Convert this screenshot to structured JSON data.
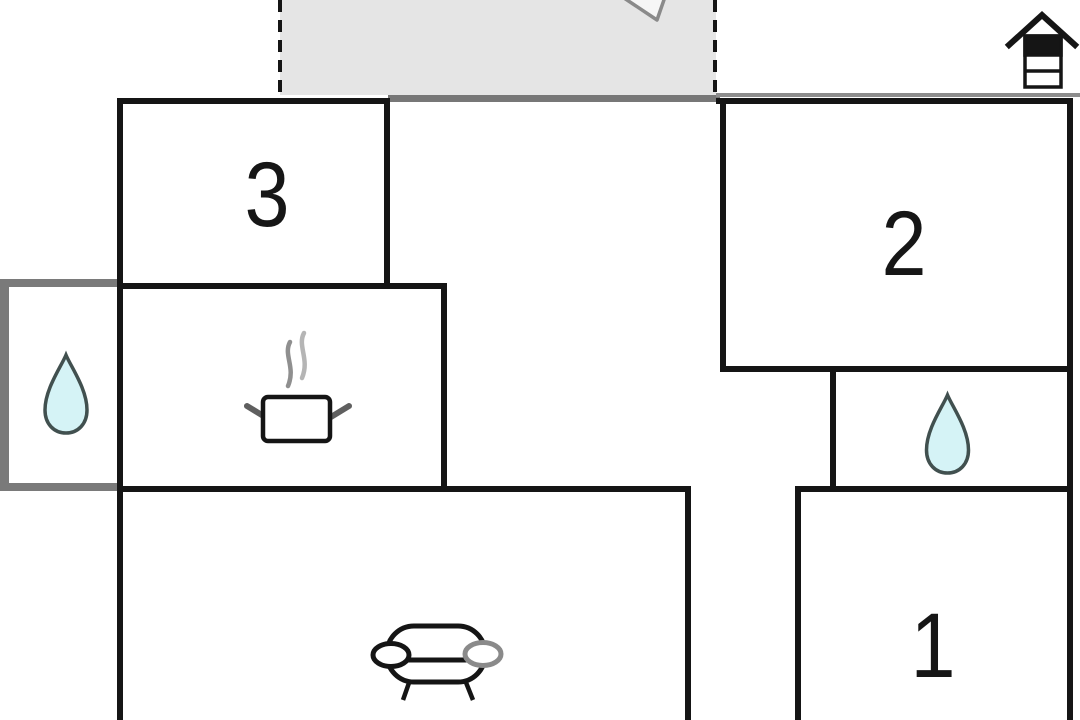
{
  "floorplan": {
    "kind": "holiday-home floor plan",
    "areas": {
      "terrace": {
        "icons": [
          "parasol-top-icon"
        ]
      },
      "room3": {
        "label": "3"
      },
      "room2": {
        "label": "2"
      },
      "room1": {
        "label": "1"
      },
      "kitchen": {
        "icons": [
          "cooking-pot-icon",
          "steam-icon"
        ]
      },
      "bathroom_left": {
        "icons": [
          "water-drop-icon"
        ]
      },
      "bathroom_right": {
        "icons": [
          "water-drop-icon"
        ]
      },
      "living_room": {
        "icons": [
          "sofa-icon"
        ]
      },
      "exterior": {
        "icons": [
          "well-icon"
        ]
      }
    },
    "colors": {
      "wall": "#151515",
      "gray_wall": "#7a7a7a",
      "terrace_fill": "#e5e5e5",
      "drop_fill": "#d5f3f6",
      "drop_stroke": "#41504f",
      "icon_gray": "#8a8a8a"
    }
  }
}
